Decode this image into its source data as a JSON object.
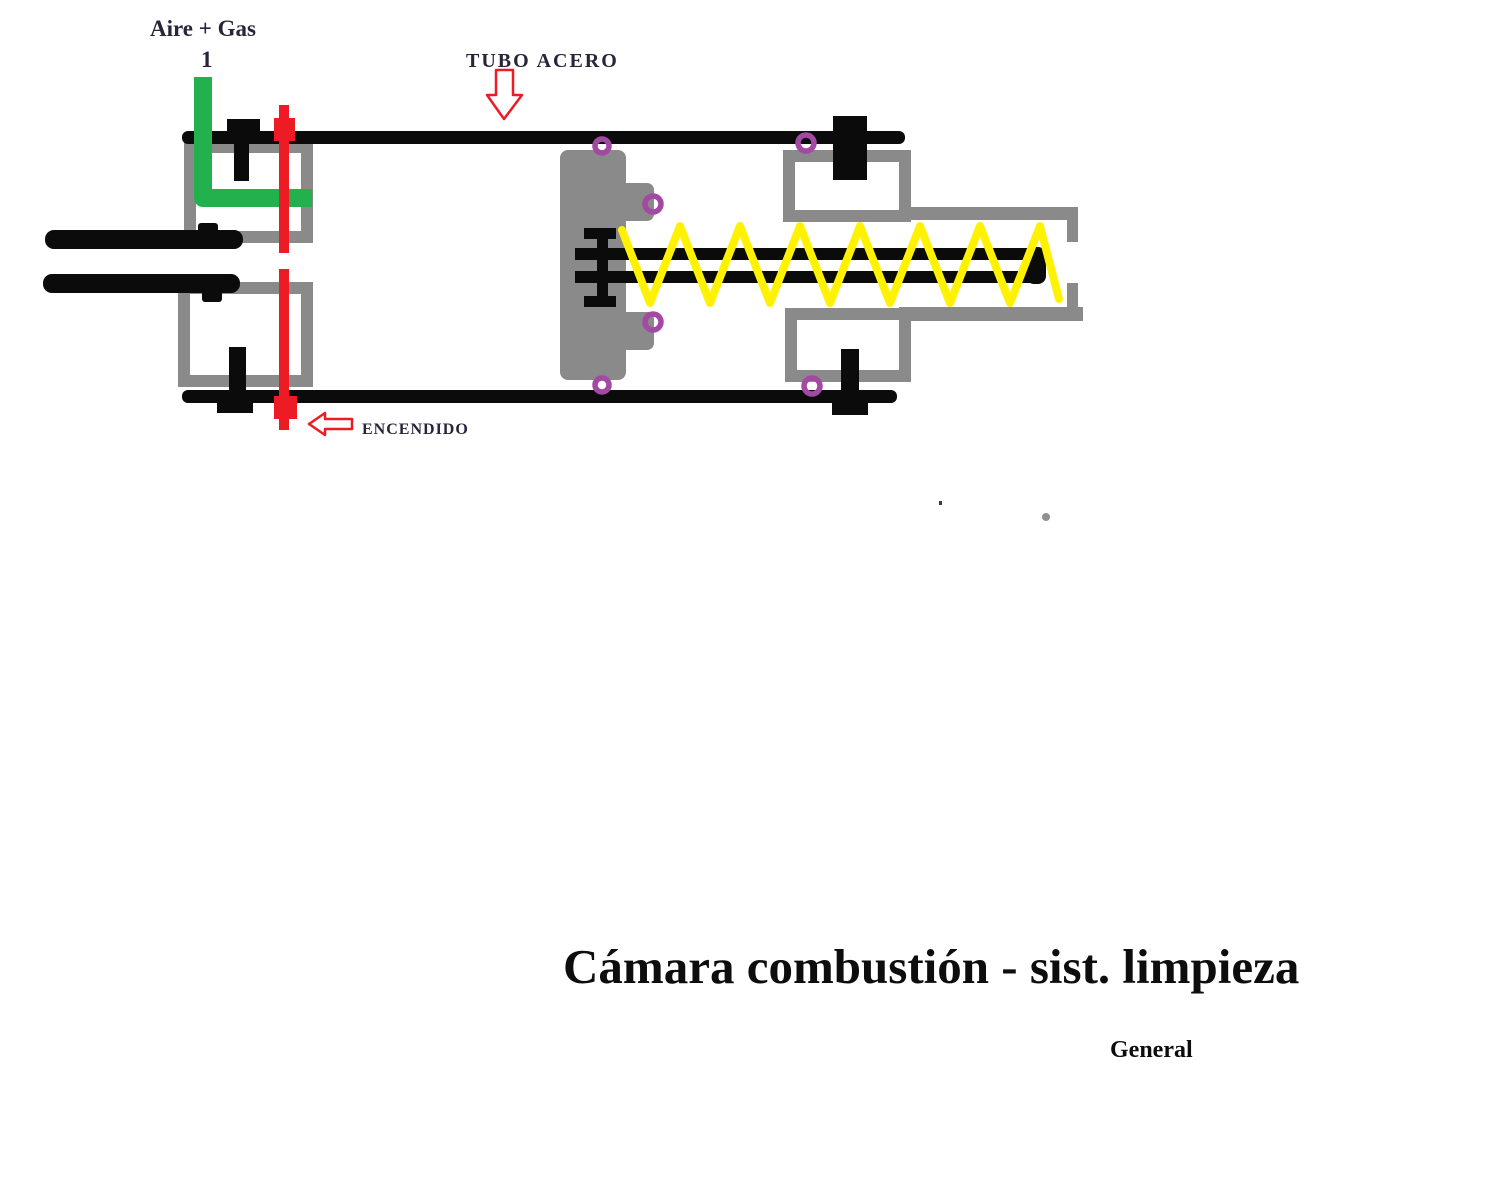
{
  "colors": {
    "metal_gray": "#8a8a8a",
    "ink_black": "#0b0b0b",
    "pipe_green": "#22b14c",
    "ignition_red": "#ed1c24",
    "spring_yellow": "#fff200",
    "bolt_purple": "#a349a4",
    "label_ink": "#29243a",
    "title_ink": "#0d0d0d"
  },
  "diagram": {
    "labels": {
      "air_gas": "Aire + Gas",
      "inlet_number": "1",
      "steel_tube": "TUBO ACERO",
      "ignition": "ENCENDIDO"
    },
    "caption": {
      "title": "Cámara combustión - sist. limpieza",
      "subtitle": "General"
    }
  }
}
